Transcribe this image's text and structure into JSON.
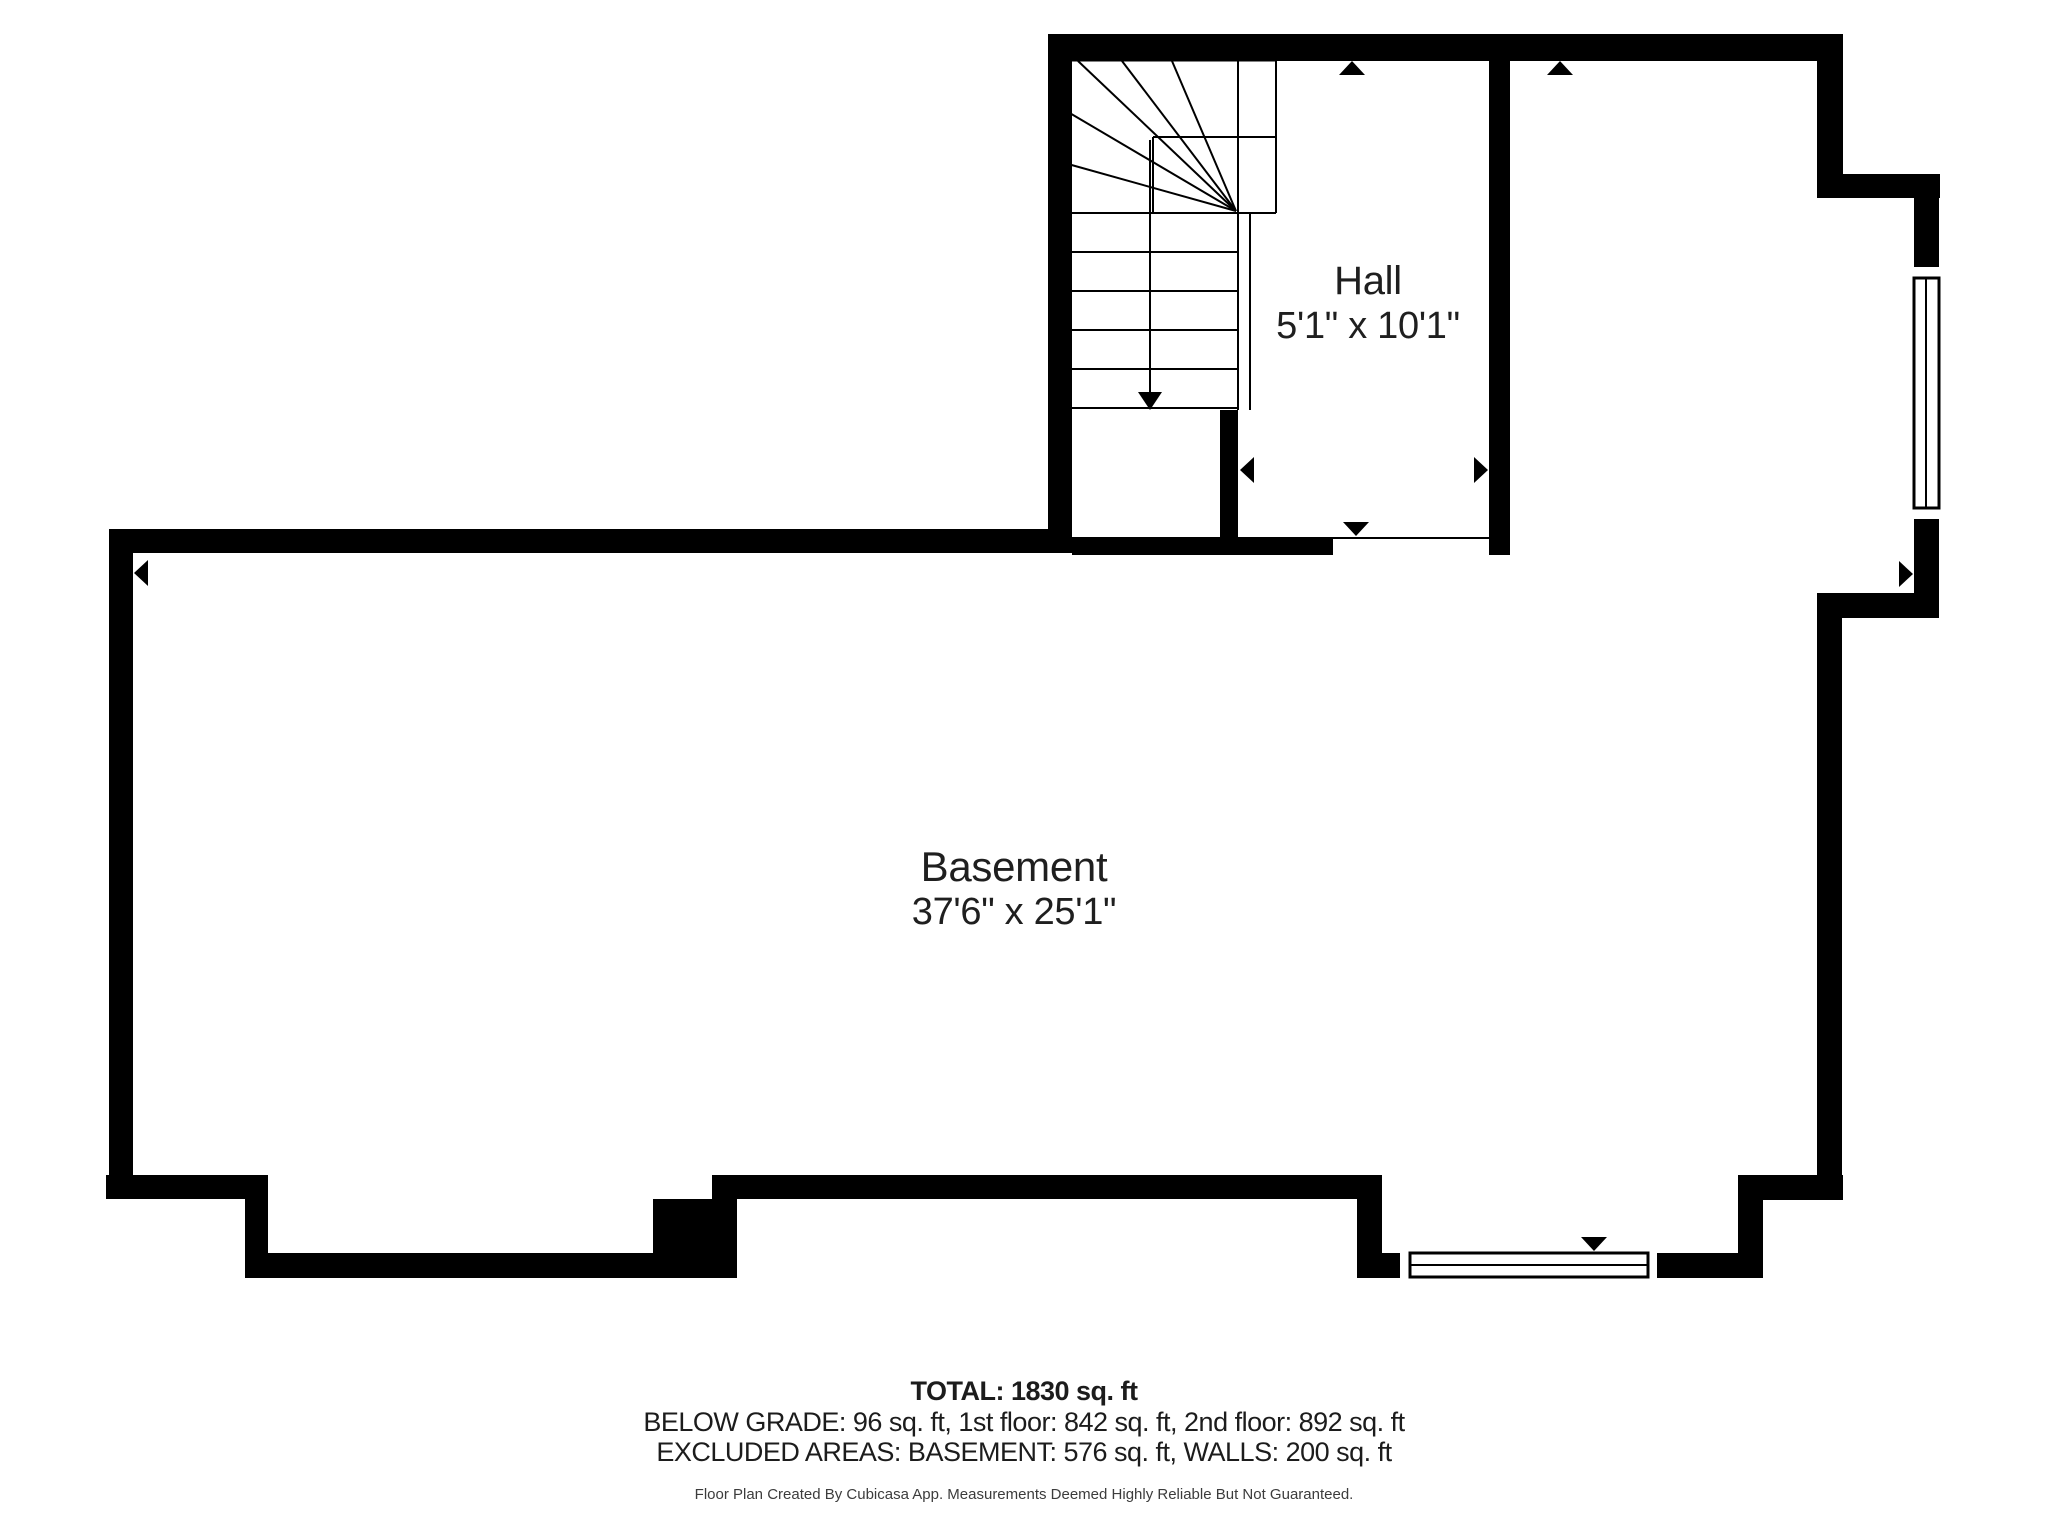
{
  "page": {
    "background": "#ffffff",
    "wall_color": "#000000",
    "text_color": "#1f1f1f"
  },
  "rooms": [
    {
      "id": "hall",
      "name": "Hall",
      "dimensions": "5'1\" x 10'1\""
    },
    {
      "id": "basement",
      "name": "Basement",
      "dimensions": "37'6\" x 25'1\""
    }
  ],
  "footer": {
    "total": "TOTAL: 1830 sq. ft",
    "below_grade": "BELOW GRADE: 96 sq. ft, 1st floor: 842 sq. ft, 2nd floor: 892 sq. ft",
    "excluded": "EXCLUDED AREAS: BASEMENT: 576 sq. ft, WALLS: 200 sq. ft",
    "disclaimer": "Floor Plan Created By Cubicasa App. Measurements Deemed Highly Reliable But Not Guaranteed."
  },
  "geometry": {
    "walls": [
      {
        "name": "top-wall",
        "x": 1048,
        "y": 34,
        "w": 795,
        "h": 27
      },
      {
        "name": "stairs-left-wall",
        "x": 1048,
        "y": 34,
        "w": 24,
        "h": 519
      },
      {
        "name": "hall-right-wall",
        "x": 1489,
        "y": 34,
        "w": 21,
        "h": 521
      },
      {
        "name": "upper-right-corner-wall",
        "x": 1817,
        "y": 34,
        "w": 26,
        "h": 164
      },
      {
        "name": "upper-step-wall",
        "x": 1817,
        "y": 174,
        "w": 123,
        "h": 24
      },
      {
        "name": "right-wall-above-window",
        "x": 1914,
        "y": 198,
        "w": 25,
        "h": 69
      },
      {
        "name": "right-wall-below-window",
        "x": 1914,
        "y": 519,
        "w": 25,
        "h": 99
      },
      {
        "name": "mid-step-wall",
        "x": 1817,
        "y": 593,
        "w": 122,
        "h": 25
      },
      {
        "name": "basement-right-wall",
        "x": 1817,
        "y": 593,
        "w": 25,
        "h": 607
      },
      {
        "name": "basement-top-wall",
        "x": 109,
        "y": 529,
        "w": 963,
        "h": 24
      },
      {
        "name": "hall-bottom-wall",
        "x": 1072,
        "y": 537,
        "w": 261,
        "h": 18
      },
      {
        "name": "stair-hall-divider-wall",
        "x": 1220,
        "y": 410,
        "w": 18,
        "h": 145
      },
      {
        "name": "basement-left-wall",
        "x": 109,
        "y": 529,
        "w": 24,
        "h": 670
      },
      {
        "name": "bottom-wall-left",
        "x": 106,
        "y": 1175,
        "w": 161,
        "h": 24
      },
      {
        "name": "bottom-step-wall-left",
        "x": 245,
        "y": 1175,
        "w": 23,
        "h": 103
      },
      {
        "name": "bottom-wall-lower-left",
        "x": 245,
        "y": 1253,
        "w": 492,
        "h": 25
      },
      {
        "name": "bottom-wall-block",
        "x": 653,
        "y": 1199,
        "w": 84,
        "h": 79
      },
      {
        "name": "bottom-wall-middle",
        "x": 712,
        "y": 1175,
        "w": 670,
        "h": 24
      },
      {
        "name": "bottom-step-wall-middle",
        "x": 1357,
        "y": 1175,
        "w": 25,
        "h": 103
      },
      {
        "name": "bottom-wall-window-left",
        "x": 1382,
        "y": 1253,
        "w": 18,
        "h": 25
      },
      {
        "name": "bottom-wall-window-right",
        "x": 1657,
        "y": 1253,
        "w": 106,
        "h": 25
      },
      {
        "name": "bottom-step-wall-right",
        "x": 1738,
        "y": 1175,
        "w": 25,
        "h": 103
      },
      {
        "name": "bottom-right-ledge-wall",
        "x": 1738,
        "y": 1175,
        "w": 105,
        "h": 25
      }
    ],
    "windows": [
      {
        "name": "window-right",
        "frame": {
          "x": 1914,
          "y": 278,
          "w": 25,
          "h": 230
        },
        "line": {
          "x1": 1926,
          "y1": 278,
          "x2": 1926,
          "y2": 508
        }
      },
      {
        "name": "window-bottom",
        "frame": {
          "x": 1410,
          "y": 1253,
          "w": 238,
          "h": 24
        },
        "line": {
          "x1": 1410,
          "y1": 1265,
          "x2": 1648,
          "y2": 1265
        }
      }
    ],
    "lines": [
      {
        "name": "stair-top-edge",
        "x1": 1068,
        "y1": 60,
        "x2": 1276,
        "y2": 60,
        "w": 3
      },
      {
        "name": "stair-edge-right",
        "x1": 1238,
        "y1": 59,
        "x2": 1238,
        "y2": 410
      },
      {
        "name": "stair-box-right",
        "x1": 1276,
        "y1": 59,
        "x2": 1276,
        "y2": 213
      },
      {
        "name": "winder-box-top",
        "x1": 1153,
        "y1": 137,
        "x2": 1276,
        "y2": 137
      },
      {
        "name": "winder-box-left",
        "x1": 1153,
        "y1": 137,
        "x2": 1153,
        "y2": 213
      },
      {
        "name": "winder-bottom",
        "x1": 1068,
        "y1": 213,
        "x2": 1276,
        "y2": 213
      },
      {
        "name": "stair-tread",
        "x1": 1068,
        "y1": 252,
        "x2": 1238,
        "y2": 252
      },
      {
        "name": "stair-tread",
        "x1": 1068,
        "y1": 291,
        "x2": 1238,
        "y2": 291
      },
      {
        "name": "stair-tread",
        "x1": 1068,
        "y1": 330,
        "x2": 1238,
        "y2": 330
      },
      {
        "name": "stair-tread",
        "x1": 1068,
        "y1": 369,
        "x2": 1238,
        "y2": 369
      },
      {
        "name": "stair-tread",
        "x1": 1068,
        "y1": 408,
        "x2": 1238,
        "y2": 408
      },
      {
        "name": "winder-fan-line",
        "x1": 1236,
        "y1": 211,
        "x2": 1078,
        "y2": 61
      },
      {
        "name": "winder-fan-line",
        "x1": 1236,
        "y1": 211,
        "x2": 1122,
        "y2": 61
      },
      {
        "name": "winder-fan-line",
        "x1": 1236,
        "y1": 211,
        "x2": 1172,
        "y2": 61
      },
      {
        "name": "winder-fan-line",
        "x1": 1236,
        "y1": 211,
        "x2": 1068,
        "y2": 112
      },
      {
        "name": "winder-fan-line",
        "x1": 1236,
        "y1": 211,
        "x2": 1068,
        "y2": 164
      },
      {
        "name": "stair-rail",
        "x1": 1250,
        "y1": 213,
        "x2": 1250,
        "y2": 410
      },
      {
        "name": "stair-direction-line",
        "x1": 1150,
        "y1": 140,
        "x2": 1150,
        "y2": 394
      },
      {
        "name": "door-threshold",
        "x1": 1333,
        "y1": 538,
        "x2": 1489,
        "y2": 538
      }
    ],
    "arrows": [
      {
        "name": "stair-down-arrow-head",
        "points": "1150,410 1138,392 1162,392"
      },
      {
        "name": "basement-width-arrow-left",
        "points": "134,573 148,560 148,586"
      },
      {
        "name": "basement-width-arrow-right",
        "points": "1913,574 1899,561 1899,587"
      },
      {
        "name": "basement-height-arrow-top",
        "points": "1560,61 1547,75 1573,75"
      },
      {
        "name": "basement-height-arrow-bottom",
        "points": "1594,1251 1581,1237 1607,1237"
      },
      {
        "name": "hall-height-arrow-top",
        "points": "1352,61 1339,75 1365,75"
      },
      {
        "name": "hall-height-arrow-bottom",
        "points": "1356,536 1343,522 1369,522"
      },
      {
        "name": "hall-width-arrow-left",
        "points": "1240,470 1254,457 1254,483"
      },
      {
        "name": "hall-width-arrow-right",
        "points": "1488,470 1474,457 1474,483"
      }
    ]
  }
}
